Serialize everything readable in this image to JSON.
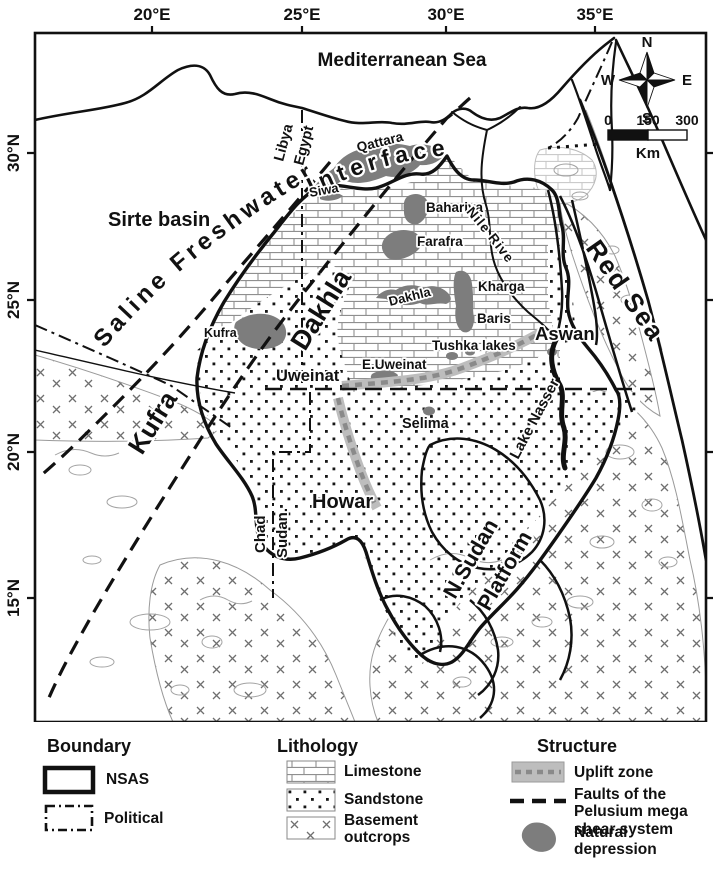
{
  "axes": {
    "top": [
      "20°E",
      "25°E",
      "30°E",
      "35°E"
    ],
    "left": [
      "30°N",
      "25°N",
      "20°N",
      "15°N"
    ]
  },
  "compass": {
    "north": "N",
    "south": "S",
    "east": "E",
    "west": "W"
  },
  "scale_bar": {
    "start": "0",
    "middle": "150",
    "end": "300",
    "unit": "Km"
  },
  "water_labels": {
    "mediterranean": "Mediterranean Sea",
    "red_sea": "Red Sea",
    "nile_river": "Nile River",
    "lake_nasser": "Lake Nasser"
  },
  "basin_labels": {
    "sirte": "Sirte basin",
    "saline_freshwater": "Saline Freshwater",
    "interface": "Interface",
    "dakhla": "Dakhla",
    "kufra": "Kufra",
    "howar": "Howar",
    "nsudan_line1": "N.Sudan",
    "nsudan_line2": "Platform"
  },
  "place_labels": {
    "siwa": "Siwa",
    "qattara": "Qattara",
    "bahariya": "Bahariya",
    "farafra": "Farafra",
    "dakhla_oasis": "Dakhla",
    "kharga": "Kharga",
    "baris": "Baris",
    "kufra_oasis": "Kufra",
    "tushka": "Tushka lakes",
    "e_uweinat": "E.Uweinat",
    "uweinat": "Uweinat",
    "aswan": "Aswan",
    "selima": "Selima"
  },
  "border_labels": {
    "libya": "Libya",
    "egypt": "Egypt",
    "chad": "Chad",
    "sudan": "Sudan."
  },
  "legend": {
    "boundary_title": "Boundary",
    "nsas": "NSAS",
    "political": "Political",
    "lithology_title": "Lithology",
    "limestone": "Limestone",
    "sandstone": "Sandstone",
    "basement": "Basement outcrops",
    "structure_title": "Structure",
    "uplift": "Uplift zone",
    "faults": "Faults of the Pelusium mega shear system",
    "depression": "Natural depression"
  },
  "colors": {
    "ink": "#111111",
    "depression_gray": "#7d7d7d",
    "uplift_gray": "#bdbdbd",
    "uplift_dash_gray": "#8a8a8a",
    "pattern_gray": "#8f8f8f"
  }
}
